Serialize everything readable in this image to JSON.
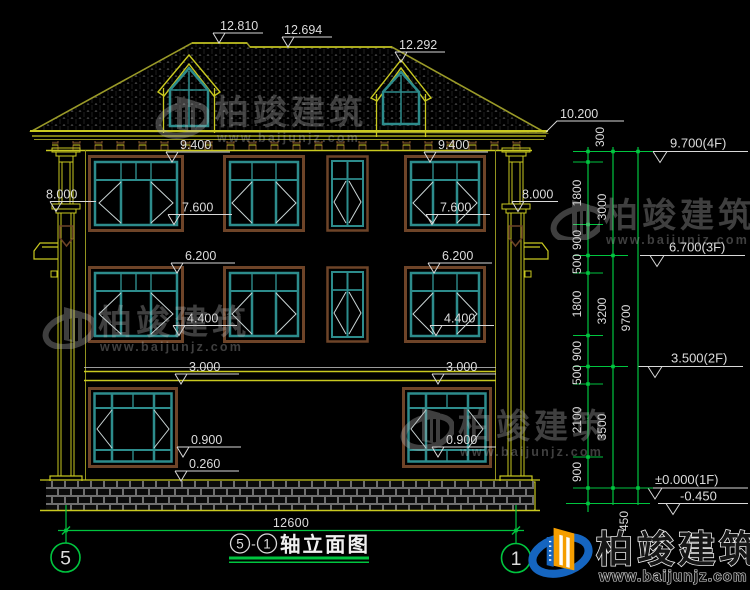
{
  "colors": {
    "dim_green": "#00c53f",
    "cad_yellow": "#c9c920",
    "frame_teal": "#2d8c8c",
    "frame_brown": "#6e4428",
    "logo_blue": "#1565c0",
    "logo_orange": "#f59e00"
  },
  "dims": {
    "ridge_main": "12.810",
    "ridge_low": "12.694",
    "dormer_peak": "12.292",
    "eave": "10.200",
    "col_top": "8.000",
    "win3_head": "9.400",
    "win3_sill": "7.600",
    "win2_head": "6.200",
    "win2_sill": "4.400",
    "floor2_top": "3.000",
    "win1_sill": "0.900",
    "plinth_top": "0.260",
    "total_width": "12600",
    "foundation": "450",
    "chain_a": [
      "300",
      "1800",
      "900",
      "500",
      "1800",
      "900",
      "500",
      "2100",
      "900"
    ],
    "chain_b": [
      "3000",
      "3200",
      "3500"
    ],
    "chain_c": [
      "9700"
    ]
  },
  "levels": {
    "f4": "9.700(4F)",
    "f3": "6.700(3F)",
    "f2": "3.500(2F)",
    "f1": "±0.000(1F)",
    "ground": "-0.450"
  },
  "axes": {
    "left": "5",
    "right": "1"
  },
  "title": {
    "axis_from": "5",
    "sep": "-",
    "axis_to": "1",
    "text": "轴立面图"
  },
  "watermark": {
    "brand": "柏竣建筑",
    "url": "www.baijunjz.com"
  },
  "brand": {
    "name": "柏竣建筑",
    "url": "www.baijunjz.com"
  }
}
